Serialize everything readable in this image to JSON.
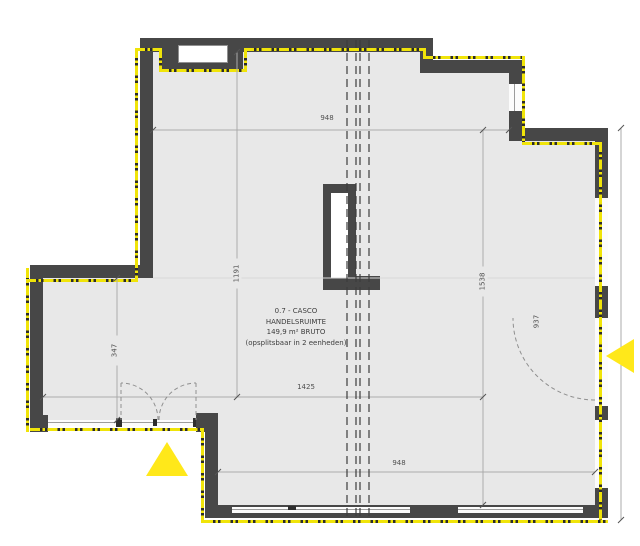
{
  "room": {
    "id_line": "0.7 - CASCO",
    "type_line": "HANDELSRUIMTE",
    "area_line": "149,9 m² BRUTO",
    "note_line": "(opsplitsbaar in 2 eenheden)"
  },
  "dims": {
    "top_width": "948",
    "upper_left_height": "1191",
    "right_height": "1538",
    "lower_left_height": "347",
    "middle_width": "1425",
    "bottom_width": "948",
    "right_door_height": "937"
  },
  "legend": {
    "entrance_marker_icon": "entrance-triangle-icon",
    "boundary_line": "unit-boundary-dash-dot",
    "split_line": "possible-split-dashed-line"
  },
  "colors": {
    "wall": "#474747",
    "floor": "#e8e8e8",
    "boundary_yellow": "#f0e409",
    "entrance_yellow": "#ffe81a"
  }
}
